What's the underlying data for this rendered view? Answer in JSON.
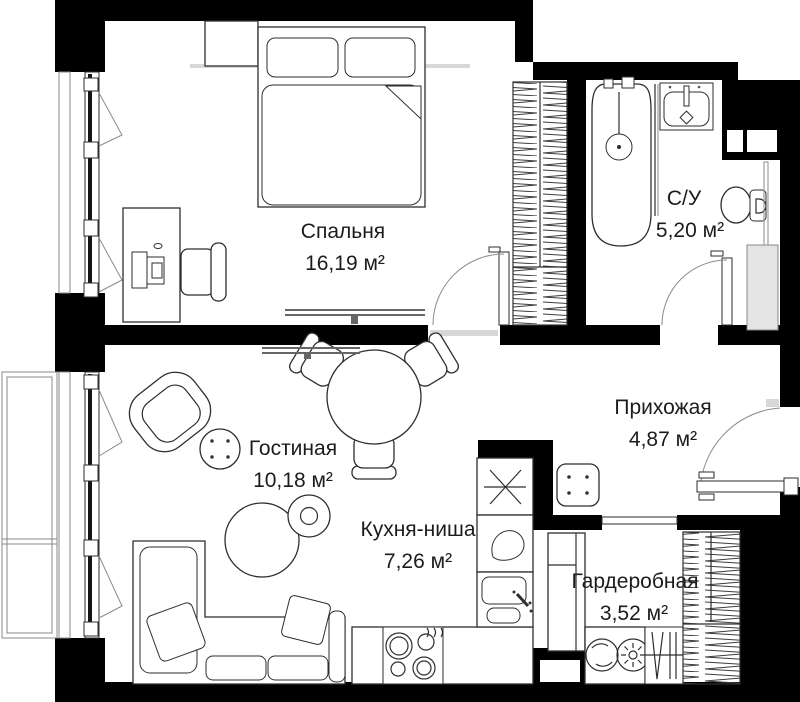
{
  "colors": {
    "wall": "#000000",
    "outline": "#2e2e2e",
    "line_light": "#8a8a8a",
    "grey_fill": "#d8d8d8",
    "duct": "#e4e4e4",
    "text": "#1c1c1c",
    "background": "#ffffff"
  },
  "rooms": {
    "bedroom": {
      "name": "Спальня",
      "area": "16,19 м²"
    },
    "bathroom": {
      "name": "С/У",
      "area": "5,20 м²"
    },
    "hallway": {
      "name": "Прихожая",
      "area": "4,87 м²"
    },
    "living_room": {
      "name": "Гостиная",
      "area": "10,18 м²"
    },
    "kitchen": {
      "name": "Кухня-ниша",
      "area": "7,26 м²"
    },
    "wardrobe": {
      "name": "Гардеробная",
      "area": "3,52 м²"
    }
  }
}
